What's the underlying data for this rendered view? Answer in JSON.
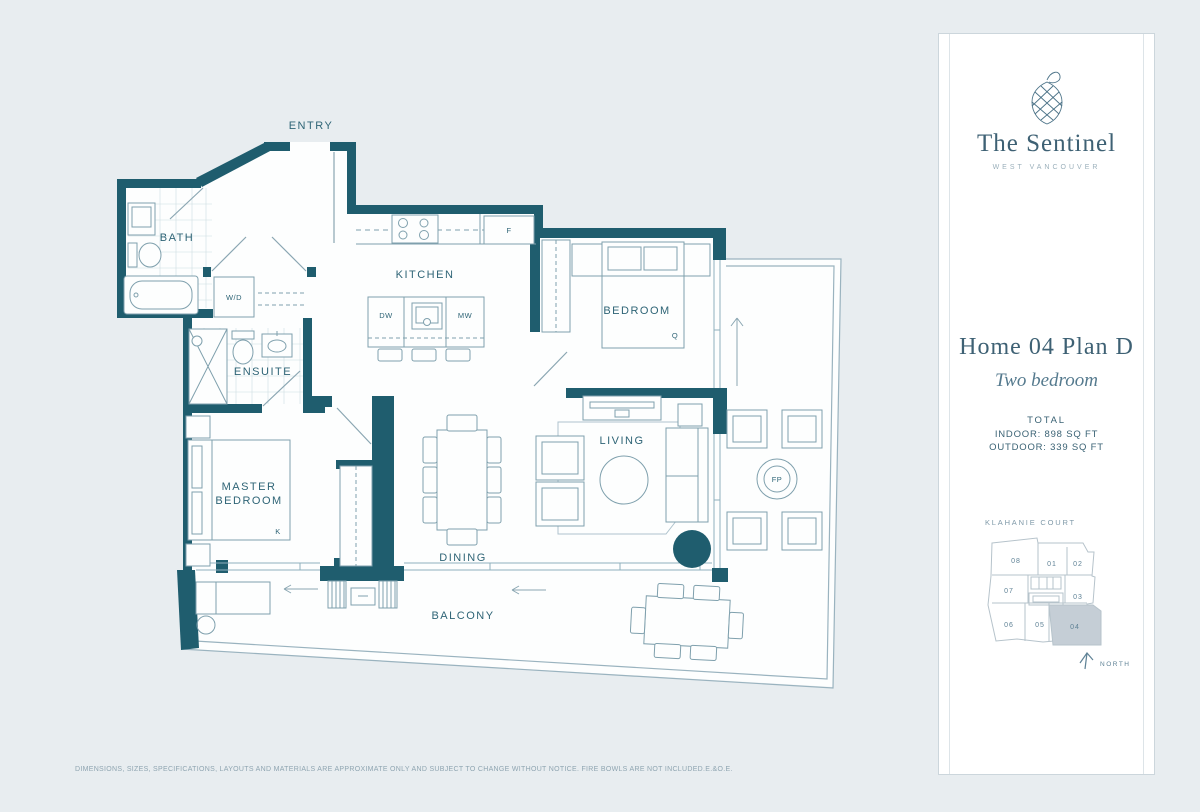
{
  "floorplan": {
    "rooms": {
      "entry": "ENTRY",
      "bath": "BATH",
      "kitchen": "KITCHEN",
      "bedroom": "BEDROOM",
      "wd": "W/D",
      "ensuite": "ENSUITE",
      "master1": "MASTER",
      "master2": "BEDROOM",
      "living": "LIVING",
      "dining": "DINING",
      "balcony": "BALCONY"
    },
    "tags": {
      "fridge": "F",
      "dishwasher": "DW",
      "microwave": "MW",
      "queen": "Q",
      "king": "K",
      "firepit": "FP"
    }
  },
  "panel": {
    "brand": "The Sentinel",
    "location": "WEST VANCOUVER",
    "plan_name": "Home 04 Plan D",
    "plan_type": "Two bedroom",
    "total_label": "TOTAL",
    "indoor": "INDOOR: 898 SQ FT",
    "outdoor": "OUTDOOR: 339 SQ FT",
    "keyplan_title": "KLAHANIE COURT",
    "north": "NORTH",
    "highlighted_unit": "04",
    "units": [
      {
        "label": "08"
      },
      {
        "label": "01"
      },
      {
        "label": "02"
      },
      {
        "label": "07"
      },
      {
        "label": "03"
      },
      {
        "label": "06"
      },
      {
        "label": "05"
      },
      {
        "label": "04"
      }
    ]
  },
  "footer": {
    "disclaimer": "DIMENSIONS, SIZES, SPECIFICATIONS, LAYOUTS AND MATERIALS ARE APPROXIMATE ONLY AND SUBJECT TO CHANGE WITHOUT NOTICE. FIRE BOWLS ARE NOT INCLUDED.E.&O.E."
  },
  "colors": {
    "wall": "#1f5d6e",
    "line": "#7fa0ad",
    "text": "#2e6476",
    "background": "#e8edf0",
    "highlight": "#c5ced6"
  }
}
